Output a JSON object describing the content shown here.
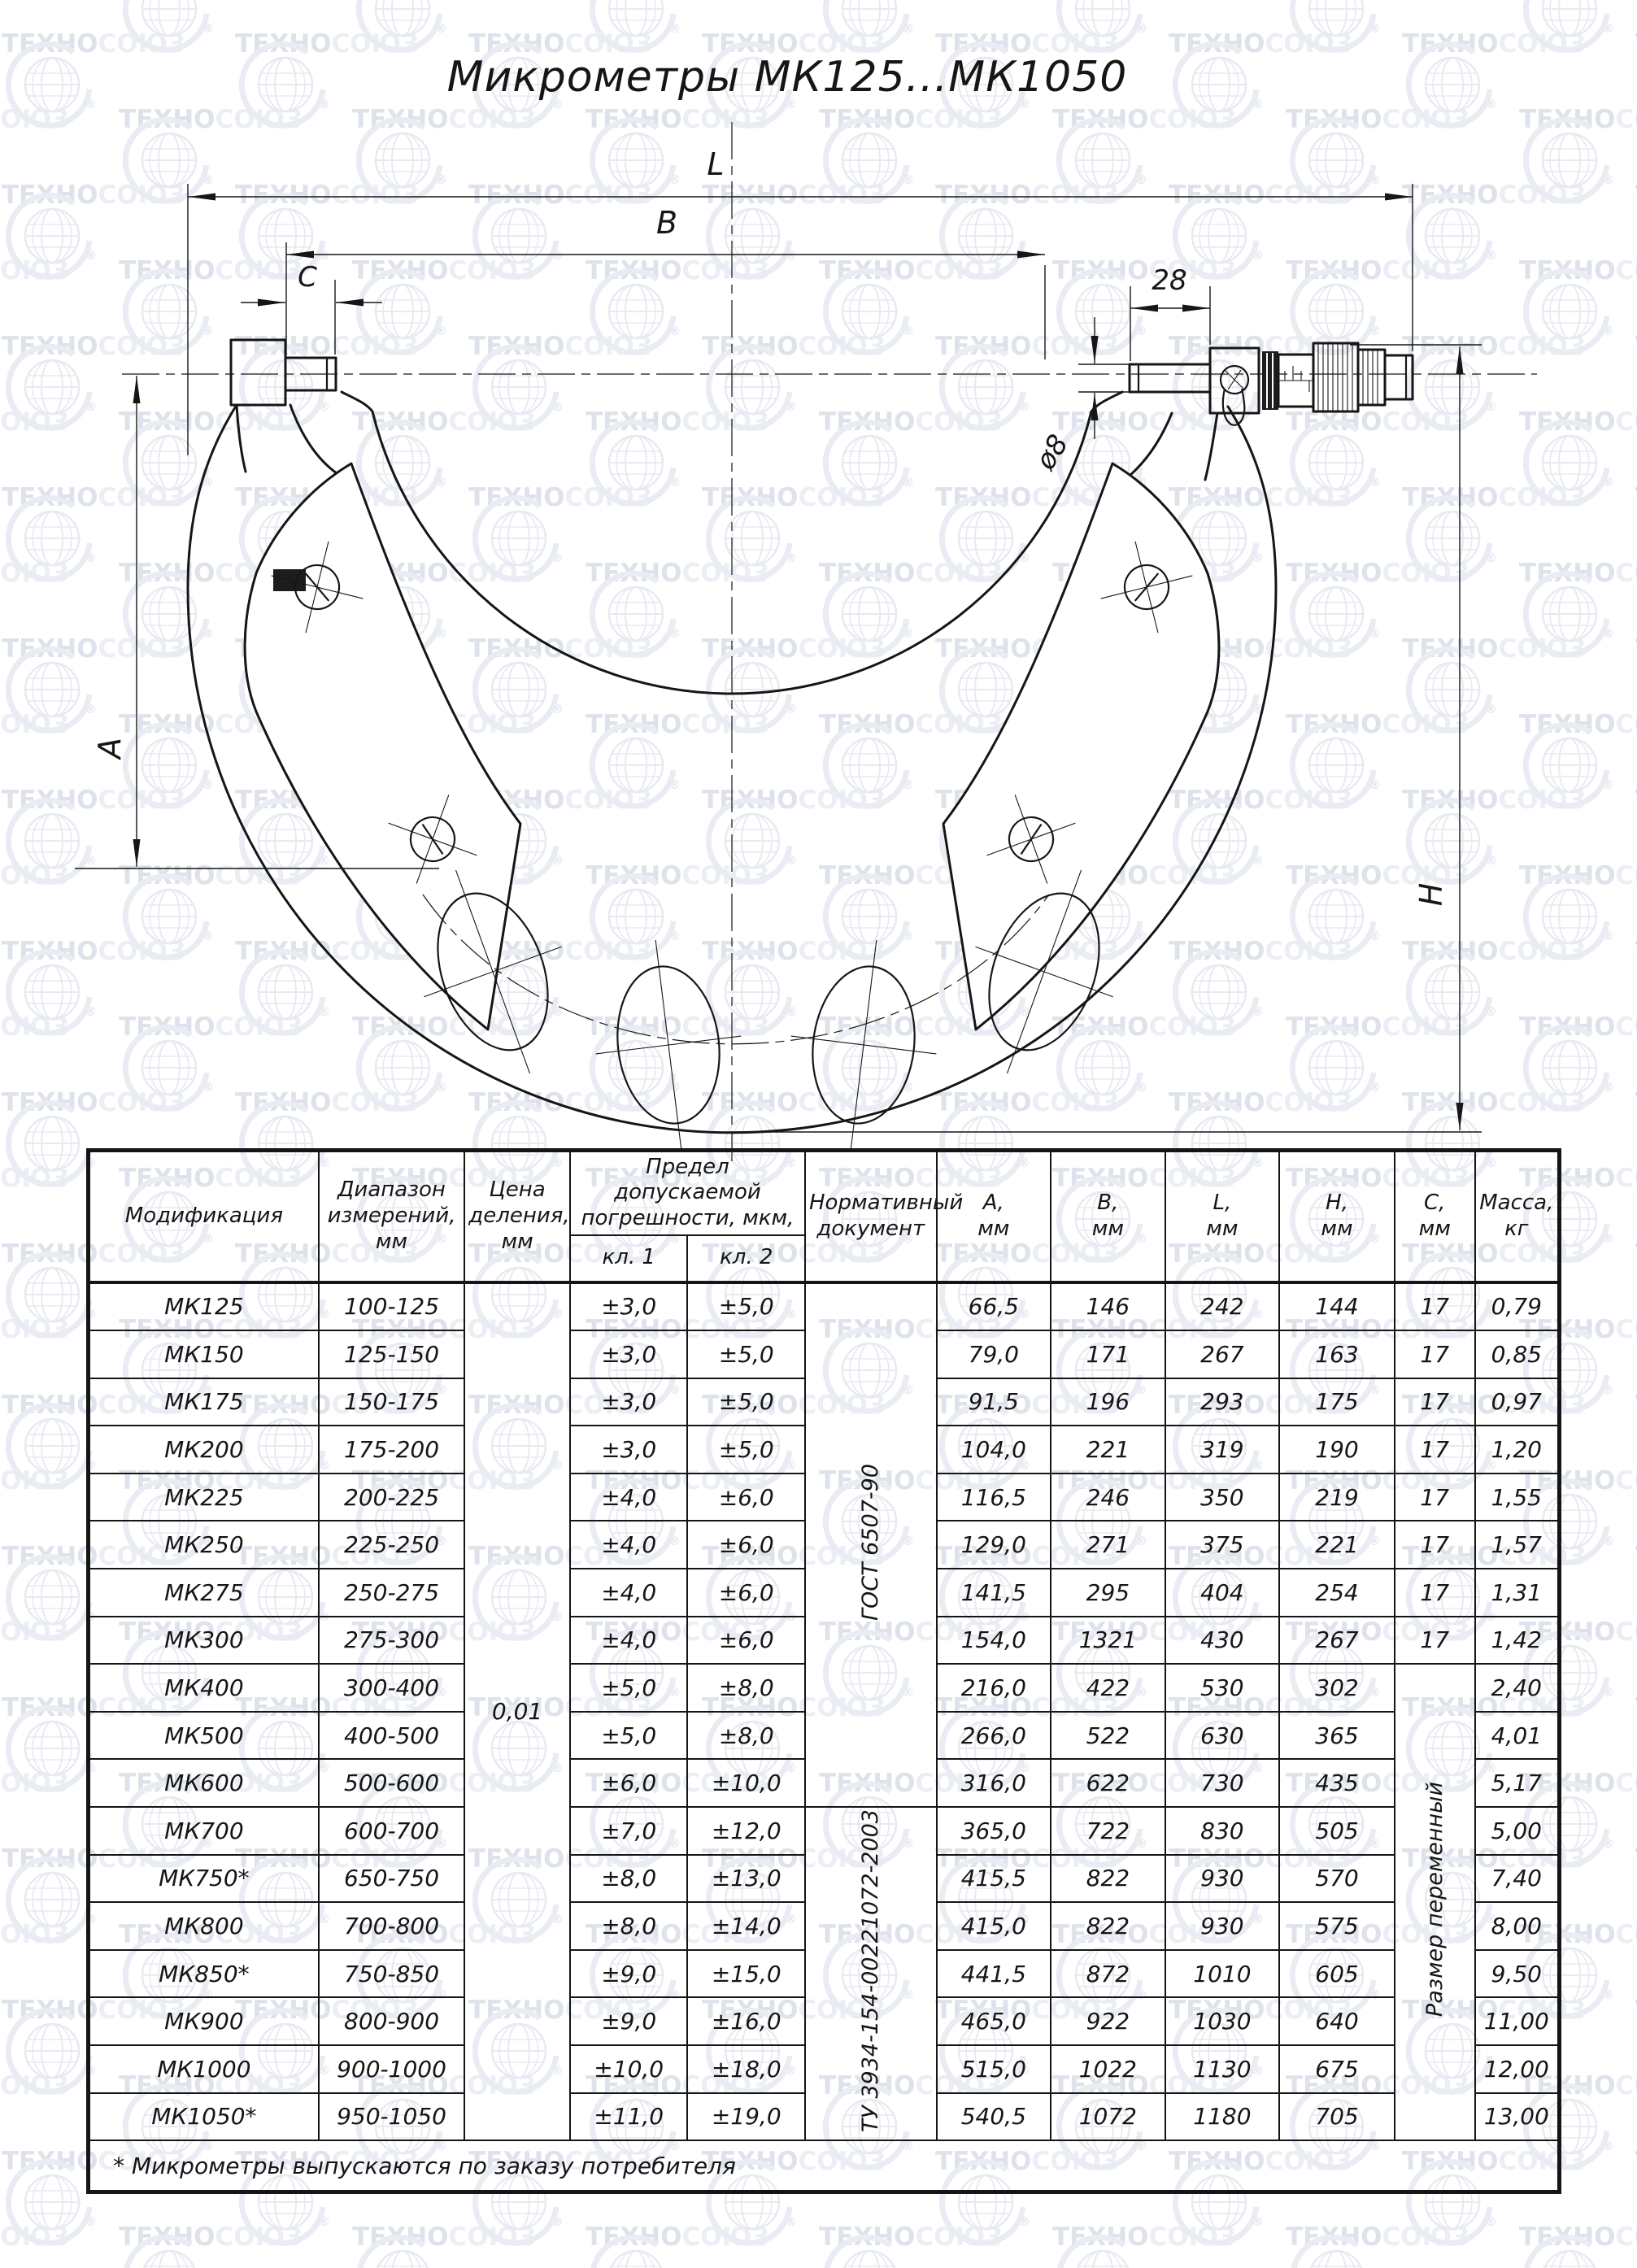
{
  "title": "Микрометры МК125...МК1050",
  "watermark": {
    "brand_part1": "ТЕХНО",
    "brand_part2": "СОЮЗ",
    "reg_mark": "®"
  },
  "drawing": {
    "dims": {
      "length_total": "L",
      "length_b": "B",
      "anvil_c": "C",
      "spindle_stickout": "28",
      "spindle_dia": "ø8",
      "depth_a": "A",
      "height_h": "H"
    }
  },
  "table": {
    "headers": {
      "modification": "Модификация",
      "range": "Диапазон\nизмерений,\nмм",
      "division": "Цена\nделения,\nмм",
      "error": "Предел допускаемой\nпогрешности, мкм,",
      "error_cl1": "кл. 1",
      "error_cl2": "кл. 2",
      "document": "Нормативный\nдокумент",
      "a": "А,\nмм",
      "b": "В,\nмм",
      "l": "L,\nмм",
      "h": "Н,\nмм",
      "c": "С,\nмм",
      "mass": "Масса,\nкг"
    },
    "division_value": "0,01",
    "documents": {
      "gost": "ГОСТ 6507-90",
      "tu": "ТУ 3934-154-00221072-2003"
    },
    "c_merged": "Размер переменный",
    "rows": [
      {
        "mod": "МК125",
        "range": "100-125",
        "cl1": "±3,0",
        "cl2": "±5,0",
        "a": "66,5",
        "b": "146",
        "l": "242",
        "h": "144",
        "c": "17",
        "mass": "0,79"
      },
      {
        "mod": "МК150",
        "range": "125-150",
        "cl1": "±3,0",
        "cl2": "±5,0",
        "a": "79,0",
        "b": "171",
        "l": "267",
        "h": "163",
        "c": "17",
        "mass": "0,85"
      },
      {
        "mod": "МК175",
        "range": "150-175",
        "cl1": "±3,0",
        "cl2": "±5,0",
        "a": "91,5",
        "b": "196",
        "l": "293",
        "h": "175",
        "c": "17",
        "mass": "0,97"
      },
      {
        "mod": "МК200",
        "range": "175-200",
        "cl1": "±3,0",
        "cl2": "±5,0",
        "a": "104,0",
        "b": "221",
        "l": "319",
        "h": "190",
        "c": "17",
        "mass": "1,20"
      },
      {
        "mod": "МК225",
        "range": "200-225",
        "cl1": "±4,0",
        "cl2": "±6,0",
        "a": "116,5",
        "b": "246",
        "l": "350",
        "h": "219",
        "c": "17",
        "mass": "1,55"
      },
      {
        "mod": "МК250",
        "range": "225-250",
        "cl1": "±4,0",
        "cl2": "±6,0",
        "a": "129,0",
        "b": "271",
        "l": "375",
        "h": "221",
        "c": "17",
        "mass": "1,57"
      },
      {
        "mod": "МК275",
        "range": "250-275",
        "cl1": "±4,0",
        "cl2": "±6,0",
        "a": "141,5",
        "b": "295",
        "l": "404",
        "h": "254",
        "c": "17",
        "mass": "1,31"
      },
      {
        "mod": "МК300",
        "range": "275-300",
        "cl1": "±4,0",
        "cl2": "±6,0",
        "a": "154,0",
        "b": "1321",
        "l": "430",
        "h": "267",
        "c": "17",
        "mass": "1,42"
      },
      {
        "mod": "МК400",
        "range": "300-400",
        "cl1": "±5,0",
        "cl2": "±8,0",
        "a": "216,0",
        "b": "422",
        "l": "530",
        "h": "302",
        "mass": "2,40"
      },
      {
        "mod": "МК500",
        "range": "400-500",
        "cl1": "±5,0",
        "cl2": "±8,0",
        "a": "266,0",
        "b": "522",
        "l": "630",
        "h": "365",
        "mass": "4,01"
      },
      {
        "mod": "МК600",
        "range": "500-600",
        "cl1": "±6,0",
        "cl2": "±10,0",
        "a": "316,0",
        "b": "622",
        "l": "730",
        "h": "435",
        "mass": "5,17"
      },
      {
        "mod": "МК700",
        "range": "600-700",
        "cl1": "±7,0",
        "cl2": "±12,0",
        "a": "365,0",
        "b": "722",
        "l": "830",
        "h": "505",
        "mass": "5,00"
      },
      {
        "mod": "МК750*",
        "range": "650-750",
        "cl1": "±8,0",
        "cl2": "±13,0",
        "a": "415,5",
        "b": "822",
        "l": "930",
        "h": "570",
        "mass": "7,40"
      },
      {
        "mod": "МК800",
        "range": "700-800",
        "cl1": "±8,0",
        "cl2": "±14,0",
        "a": "415,0",
        "b": "822",
        "l": "930",
        "h": "575",
        "mass": "8,00"
      },
      {
        "mod": "МК850*",
        "range": "750-850",
        "cl1": "±9,0",
        "cl2": "±15,0",
        "a": "441,5",
        "b": "872",
        "l": "1010",
        "h": "605",
        "mass": "9,50"
      },
      {
        "mod": "МК900",
        "range": "800-900",
        "cl1": "±9,0",
        "cl2": "±16,0",
        "a": "465,0",
        "b": "922",
        "l": "1030",
        "h": "640",
        "mass": "11,00"
      },
      {
        "mod": "МК1000",
        "range": "900-1000",
        "cl1": "±10,0",
        "cl2": "±18,0",
        "a": "515,0",
        "b": "1022",
        "l": "1130",
        "h": "675",
        "mass": "12,00"
      },
      {
        "mod": "МК1050*",
        "range": "950-1050",
        "cl1": "±11,0",
        "cl2": "±19,0",
        "a": "540,5",
        "b": "1072",
        "l": "1180",
        "h": "705",
        "mass": "13,00"
      }
    ],
    "gost_rowspan": 11,
    "tu_rowspan": 7,
    "c_plain_rows": 8,
    "footnote": "* Микрометры выпускаются по заказу потребителя"
  }
}
